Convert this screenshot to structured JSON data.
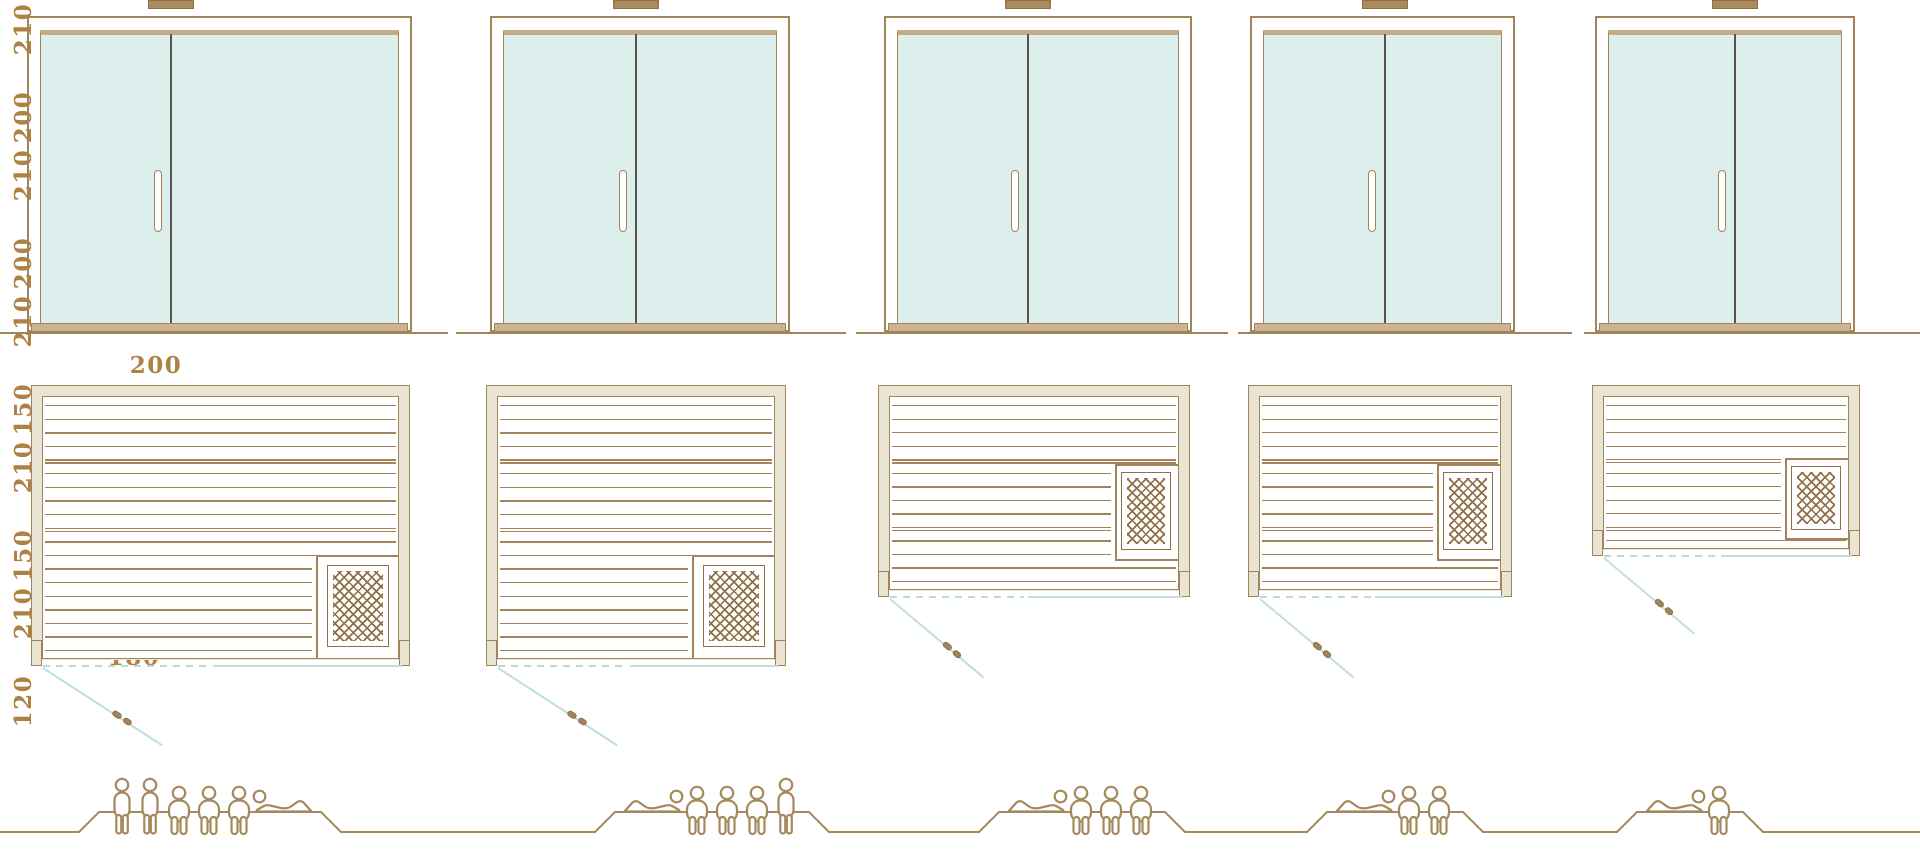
{
  "page": {
    "title": "Sauna model size comparison diagram",
    "dimension_unit": "cm"
  },
  "colors": {
    "outline_brown": "#a1845a",
    "dimension_text": "#ae8145",
    "wall_beige": "#e9e5d2",
    "glass_teal": "#ddefec",
    "door_swing_teal": "#bedfdc",
    "heater_brown": "#8f6f45",
    "door_split_dark": "#57534a"
  },
  "saunas": [
    {
      "id": "sauna-1",
      "height_label": "210",
      "width_label": "250",
      "depth_label": "200",
      "height_cm": 210,
      "width_cm": 250,
      "depth_cm": 200,
      "capacity_total": 6,
      "capacity_figures": [
        "standing",
        "standing",
        "seated",
        "seated",
        "seated",
        "lying-head-left"
      ]
    },
    {
      "id": "sauna-2",
      "height_label": "210",
      "width_label": "200",
      "depth_label": "200",
      "height_cm": 210,
      "width_cm": 200,
      "depth_cm": 200,
      "capacity_total": 5,
      "capacity_figures": [
        "lying-head-right",
        "seated",
        "seated",
        "seated",
        "standing"
      ]
    },
    {
      "id": "sauna-3",
      "height_label": "210",
      "width_label": "200",
      "depth_label": "150",
      "height_cm": 210,
      "width_cm": 200,
      "depth_cm": 150,
      "capacity_total": 4,
      "capacity_figures": [
        "lying-head-right",
        "seated",
        "seated",
        "seated"
      ]
    },
    {
      "id": "sauna-4",
      "height_label": "210",
      "width_label": "180",
      "depth_label": "150",
      "height_cm": 210,
      "width_cm": 180,
      "depth_cm": 150,
      "capacity_total": 3,
      "capacity_figures": [
        "lying-head-right",
        "seated",
        "seated"
      ]
    },
    {
      "id": "sauna-5",
      "height_label": "210",
      "width_label": "180",
      "depth_label": "120",
      "height_cm": 210,
      "width_cm": 180,
      "depth_cm": 120,
      "capacity_total": 2,
      "capacity_figures": [
        "lying-head-right",
        "seated"
      ]
    }
  ]
}
